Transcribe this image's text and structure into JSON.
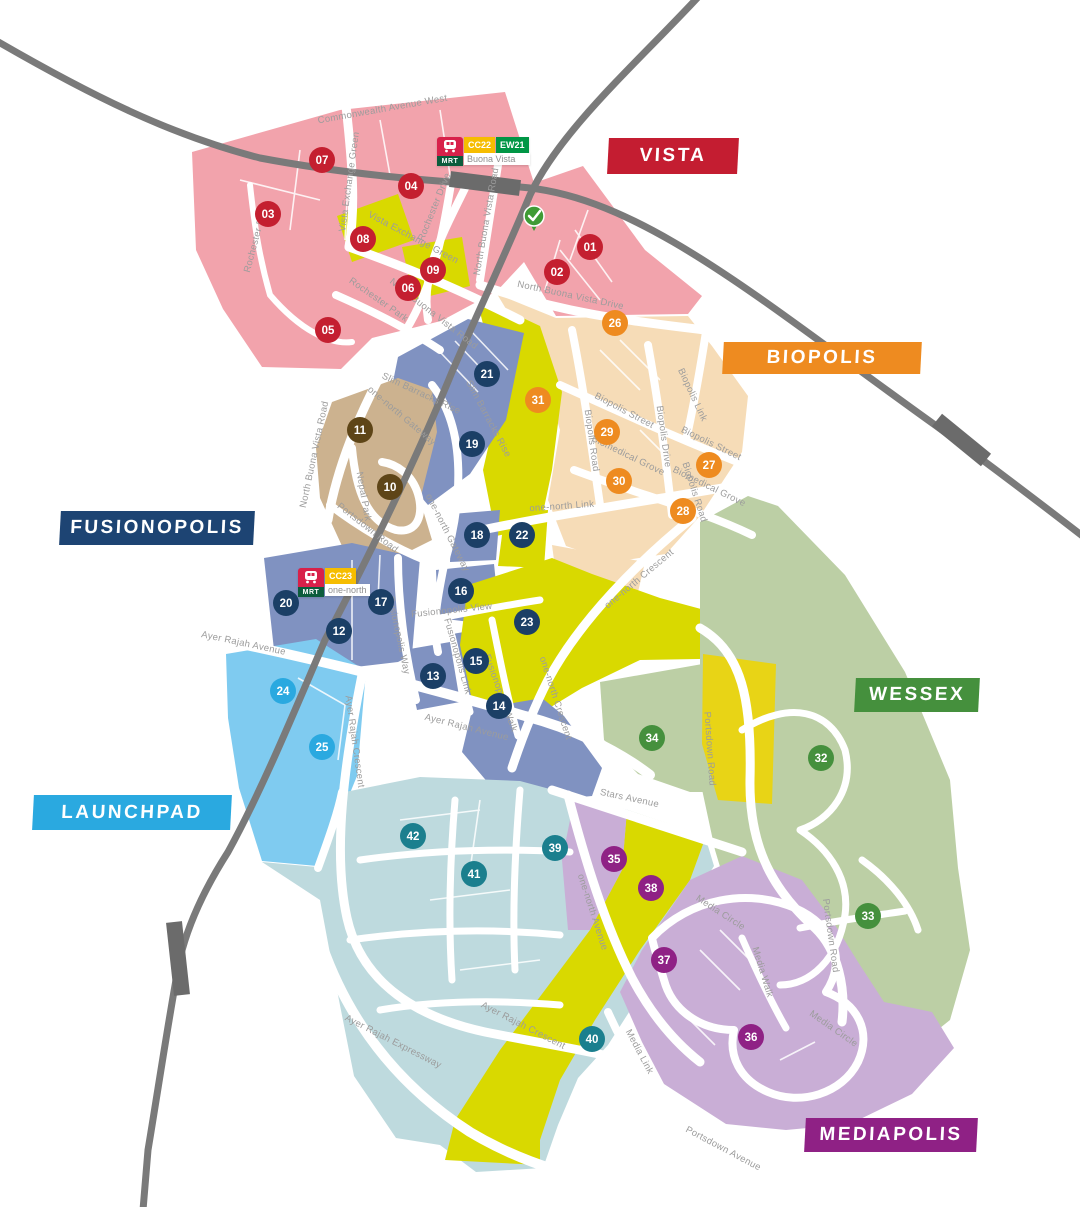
{
  "map_title": "one-north district map",
  "districts": [
    {
      "id": "vista",
      "label": "VISTA",
      "color": "#c41d31",
      "x": 608,
      "y": 138,
      "w": 130,
      "h": 36
    },
    {
      "id": "biopolis",
      "label": "BIOPOLIS",
      "color": "#ee8b20",
      "x": 723,
      "y": 342,
      "w": 198,
      "h": 32
    },
    {
      "id": "fusionopolis",
      "label": "FUSIONOPOLIS",
      "color": "#1d4473",
      "x": 60,
      "y": 511,
      "w": 194,
      "h": 34
    },
    {
      "id": "wessex",
      "label": "WESSEX",
      "color": "#45903d",
      "x": 855,
      "y": 678,
      "w": 124,
      "h": 34
    },
    {
      "id": "launchpad",
      "label": "LAUNCHPAD",
      "color": "#2aa9e0",
      "x": 33,
      "y": 795,
      "w": 198,
      "h": 35
    },
    {
      "id": "mediapolis",
      "label": "MEDIAPOLIS",
      "color": "#8f2185",
      "x": 805,
      "y": 1118,
      "w": 172,
      "h": 34
    }
  ],
  "mrt_stations": [
    {
      "name": "Buona Vista",
      "x": 437,
      "y": 137,
      "lines": [
        {
          "code": "CC22",
          "color": "#f6bd00"
        },
        {
          "code": "EW21",
          "color": "#009645"
        }
      ]
    },
    {
      "name": "one-north",
      "x": 298,
      "y": 568,
      "lines": [
        {
          "code": "CC23",
          "color": "#f6bd00"
        }
      ]
    }
  ],
  "marker_colors": {
    "vista": "#c41f30",
    "nepal": "#5e4517",
    "fusionopolis": "#1b3f66",
    "launchpad": "#2aa9e0",
    "biopolis": "#ee8b20",
    "wessex": "#45903d",
    "mediapolis": "#8f2185",
    "jtc": "#1b7f8e"
  },
  "markers": [
    {
      "n": "01",
      "x": 590,
      "y": 247,
      "g": "vista"
    },
    {
      "n": "02",
      "x": 557,
      "y": 272,
      "g": "vista"
    },
    {
      "n": "03",
      "x": 268,
      "y": 214,
      "g": "vista"
    },
    {
      "n": "04",
      "x": 411,
      "y": 186,
      "g": "vista"
    },
    {
      "n": "05",
      "x": 328,
      "y": 330,
      "g": "vista"
    },
    {
      "n": "06",
      "x": 408,
      "y": 288,
      "g": "vista"
    },
    {
      "n": "07",
      "x": 322,
      "y": 160,
      "g": "vista"
    },
    {
      "n": "08",
      "x": 363,
      "y": 239,
      "g": "vista"
    },
    {
      "n": "09",
      "x": 433,
      "y": 270,
      "g": "vista"
    },
    {
      "n": "10",
      "x": 390,
      "y": 487,
      "g": "nepal"
    },
    {
      "n": "11",
      "x": 360,
      "y": 430,
      "g": "nepal"
    },
    {
      "n": "12",
      "x": 339,
      "y": 631,
      "g": "fusionopolis"
    },
    {
      "n": "13",
      "x": 433,
      "y": 676,
      "g": "fusionopolis"
    },
    {
      "n": "14",
      "x": 499,
      "y": 706,
      "g": "fusionopolis"
    },
    {
      "n": "15",
      "x": 476,
      "y": 661,
      "g": "fusionopolis"
    },
    {
      "n": "16",
      "x": 461,
      "y": 591,
      "g": "fusionopolis"
    },
    {
      "n": "17",
      "x": 381,
      "y": 602,
      "g": "fusionopolis"
    },
    {
      "n": "18",
      "x": 477,
      "y": 535,
      "g": "fusionopolis"
    },
    {
      "n": "19",
      "x": 472,
      "y": 444,
      "g": "fusionopolis"
    },
    {
      "n": "20",
      "x": 286,
      "y": 603,
      "g": "fusionopolis"
    },
    {
      "n": "21",
      "x": 487,
      "y": 374,
      "g": "fusionopolis"
    },
    {
      "n": "22",
      "x": 522,
      "y": 535,
      "g": "fusionopolis"
    },
    {
      "n": "23",
      "x": 527,
      "y": 622,
      "g": "fusionopolis"
    },
    {
      "n": "24",
      "x": 283,
      "y": 691,
      "g": "launchpad"
    },
    {
      "n": "25",
      "x": 322,
      "y": 747,
      "g": "launchpad"
    },
    {
      "n": "26",
      "x": 615,
      "y": 323,
      "g": "biopolis"
    },
    {
      "n": "27",
      "x": 709,
      "y": 465,
      "g": "biopolis"
    },
    {
      "n": "28",
      "x": 683,
      "y": 511,
      "g": "biopolis"
    },
    {
      "n": "29",
      "x": 607,
      "y": 432,
      "g": "biopolis"
    },
    {
      "n": "30",
      "x": 619,
      "y": 481,
      "g": "biopolis"
    },
    {
      "n": "31",
      "x": 538,
      "y": 400,
      "g": "biopolis"
    },
    {
      "n": "32",
      "x": 821,
      "y": 758,
      "g": "wessex"
    },
    {
      "n": "33",
      "x": 868,
      "y": 916,
      "g": "wessex"
    },
    {
      "n": "34",
      "x": 652,
      "y": 738,
      "g": "wessex"
    },
    {
      "n": "35",
      "x": 614,
      "y": 859,
      "g": "mediapolis"
    },
    {
      "n": "36",
      "x": 751,
      "y": 1037,
      "g": "mediapolis"
    },
    {
      "n": "37",
      "x": 664,
      "y": 960,
      "g": "mediapolis"
    },
    {
      "n": "38",
      "x": 651,
      "y": 888,
      "g": "mediapolis"
    },
    {
      "n": "39",
      "x": 555,
      "y": 848,
      "g": "jtc"
    },
    {
      "n": "40",
      "x": 592,
      "y": 1039,
      "g": "jtc"
    },
    {
      "n": "41",
      "x": 474,
      "y": 874,
      "g": "jtc"
    },
    {
      "n": "42",
      "x": 413,
      "y": 836,
      "g": "jtc"
    }
  ],
  "road_labels": [
    {
      "t": "Commonwealth Avenue West",
      "x": 383,
      "y": 112,
      "r": -10
    },
    {
      "t": "Vista Exchange Green",
      "x": 352,
      "y": 182,
      "r": -82
    },
    {
      "t": "Vista Exchange Green",
      "x": 412,
      "y": 240,
      "r": 28
    },
    {
      "t": "Rochester Drive",
      "x": 259,
      "y": 238,
      "r": -75
    },
    {
      "t": "Rochester Drive",
      "x": 437,
      "y": 208,
      "r": -68
    },
    {
      "t": "Rochester Park",
      "x": 377,
      "y": 302,
      "r": 35
    },
    {
      "t": "North Buona Vista Road",
      "x": 432,
      "y": 316,
      "r": 38
    },
    {
      "t": "North Buona Vista Road",
      "x": 489,
      "y": 222,
      "r": -80
    },
    {
      "t": "North Buona Vista Drive",
      "x": 570,
      "y": 298,
      "r": 12
    },
    {
      "t": "North Buona Vista Road",
      "x": 317,
      "y": 455,
      "r": -78
    },
    {
      "t": "Slim Barracks Rise",
      "x": 420,
      "y": 396,
      "r": 25
    },
    {
      "t": "Slim Barracks Rise",
      "x": 486,
      "y": 420,
      "r": 62
    },
    {
      "t": "one-north Gateway",
      "x": 400,
      "y": 418,
      "r": 40
    },
    {
      "t": "one-north Gateway",
      "x": 445,
      "y": 534,
      "r": 63
    },
    {
      "t": "one-north Link",
      "x": 562,
      "y": 509,
      "r": -4
    },
    {
      "t": "Biopolis Street",
      "x": 623,
      "y": 413,
      "r": 28
    },
    {
      "t": "Biopolis Street",
      "x": 710,
      "y": 446,
      "r": 26
    },
    {
      "t": "Biopolis Road",
      "x": 589,
      "y": 441,
      "r": 82
    },
    {
      "t": "Biopolis Road",
      "x": 692,
      "y": 493,
      "r": 72
    },
    {
      "t": "Biopolis Drive",
      "x": 661,
      "y": 437,
      "r": 82
    },
    {
      "t": "Biopolis Link",
      "x": 690,
      "y": 396,
      "r": 65
    },
    {
      "t": "Biomedical Grove",
      "x": 627,
      "y": 458,
      "r": 26
    },
    {
      "t": "Biomedical Grove",
      "x": 708,
      "y": 489,
      "r": 26
    },
    {
      "t": "Portsdown Road",
      "x": 366,
      "y": 530,
      "r": 38
    },
    {
      "t": "Portsdown Road",
      "x": 707,
      "y": 749,
      "r": 86
    },
    {
      "t": "Portsdown Road",
      "x": 828,
      "y": 936,
      "r": 82
    },
    {
      "t": "Nepal Park",
      "x": 361,
      "y": 497,
      "r": 80
    },
    {
      "t": "one-north Crescent",
      "x": 641,
      "y": 581,
      "r": -40
    },
    {
      "t": "one-north Crescent",
      "x": 553,
      "y": 699,
      "r": 72
    },
    {
      "t": "Fusionopolis View",
      "x": 452,
      "y": 613,
      "r": -6
    },
    {
      "t": "Fusionopolis Way",
      "x": 396,
      "y": 636,
      "r": 78
    },
    {
      "t": "Fusionopolis Link",
      "x": 455,
      "y": 657,
      "r": 74
    },
    {
      "t": "Fusionopolis Walk",
      "x": 498,
      "y": 694,
      "r": 70
    },
    {
      "t": "Ayer Rajah Avenue",
      "x": 243,
      "y": 646,
      "r": 12
    },
    {
      "t": "Ayer Rajah Avenue",
      "x": 466,
      "y": 730,
      "r": 14
    },
    {
      "t": "Ayer Rajah Crescent",
      "x": 352,
      "y": 742,
      "r": 82
    },
    {
      "t": "Ayer Rajah Crescent",
      "x": 522,
      "y": 1028,
      "r": 27
    },
    {
      "t": "Ayer Rajah Expressway",
      "x": 392,
      "y": 1044,
      "r": 27
    },
    {
      "t": "Stars Avenue",
      "x": 629,
      "y": 801,
      "r": 12
    },
    {
      "t": "one-north Avenue",
      "x": 590,
      "y": 913,
      "r": 72
    },
    {
      "t": "Media Link",
      "x": 637,
      "y": 1053,
      "r": 62
    },
    {
      "t": "Media Circle",
      "x": 719,
      "y": 915,
      "r": 33
    },
    {
      "t": "Media Circle",
      "x": 832,
      "y": 1031,
      "r": 35
    },
    {
      "t": "Media Walk",
      "x": 760,
      "y": 973,
      "r": 73
    },
    {
      "t": "Portsdown Avenue",
      "x": 722,
      "y": 1151,
      "r": 28
    }
  ],
  "checkpoint_icon": {
    "glyph": "check",
    "color": "#3f9b35",
    "x": 534,
    "y": 217
  }
}
